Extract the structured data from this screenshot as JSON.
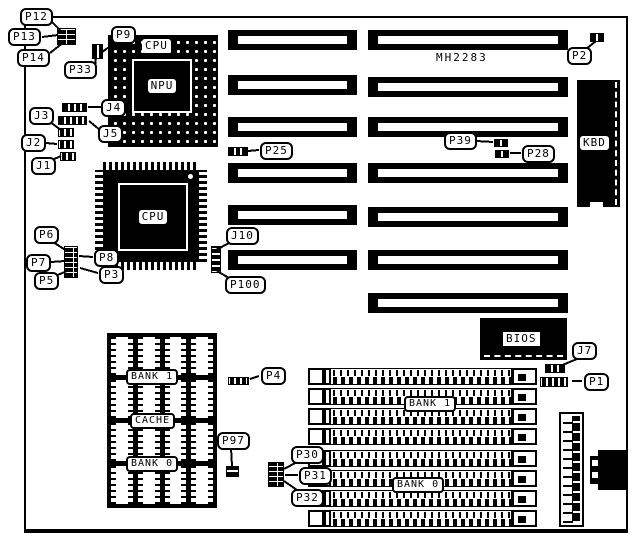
{
  "figure": {
    "board_model": "MH2283",
    "cpu_socket_label": "CPU",
    "npu_label": "NPU",
    "cpu_chip_label": "CPU",
    "keyboard_label": "KBD",
    "bios_label": "BIOS",
    "cache": {
      "bank1": "BANK 1",
      "title": "CACHE",
      "bank0": "BANK 0"
    },
    "memory": {
      "bank1": "BANK 1",
      "bank0": "BANK 0"
    }
  },
  "callouts": [
    {
      "id": "P12",
      "label": "P12"
    },
    {
      "id": "P13",
      "label": "P13"
    },
    {
      "id": "P14",
      "label": "P14"
    },
    {
      "id": "P9",
      "label": "P9"
    },
    {
      "id": "P33",
      "label": "P33"
    },
    {
      "id": "J3",
      "label": "J3"
    },
    {
      "id": "J2",
      "label": "J2"
    },
    {
      "id": "J1",
      "label": "J1"
    },
    {
      "id": "J4",
      "label": "J4"
    },
    {
      "id": "J5",
      "label": "J5"
    },
    {
      "id": "P25",
      "label": "P25"
    },
    {
      "id": "P2",
      "label": "P2"
    },
    {
      "id": "P39",
      "label": "P39"
    },
    {
      "id": "P28",
      "label": "P28"
    },
    {
      "id": "P6",
      "label": "P6"
    },
    {
      "id": "P7",
      "label": "P7"
    },
    {
      "id": "P5",
      "label": "P5"
    },
    {
      "id": "P8",
      "label": "P8"
    },
    {
      "id": "P3",
      "label": "P3"
    },
    {
      "id": "J10",
      "label": "J10"
    },
    {
      "id": "P100",
      "label": "P100"
    },
    {
      "id": "P4",
      "label": "P4"
    },
    {
      "id": "P97",
      "label": "P97"
    },
    {
      "id": "P30",
      "label": "P30"
    },
    {
      "id": "P31",
      "label": "P31"
    },
    {
      "id": "P32",
      "label": "P32"
    },
    {
      "id": "J7",
      "label": "J7"
    },
    {
      "id": "P1",
      "label": "P1"
    }
  ]
}
